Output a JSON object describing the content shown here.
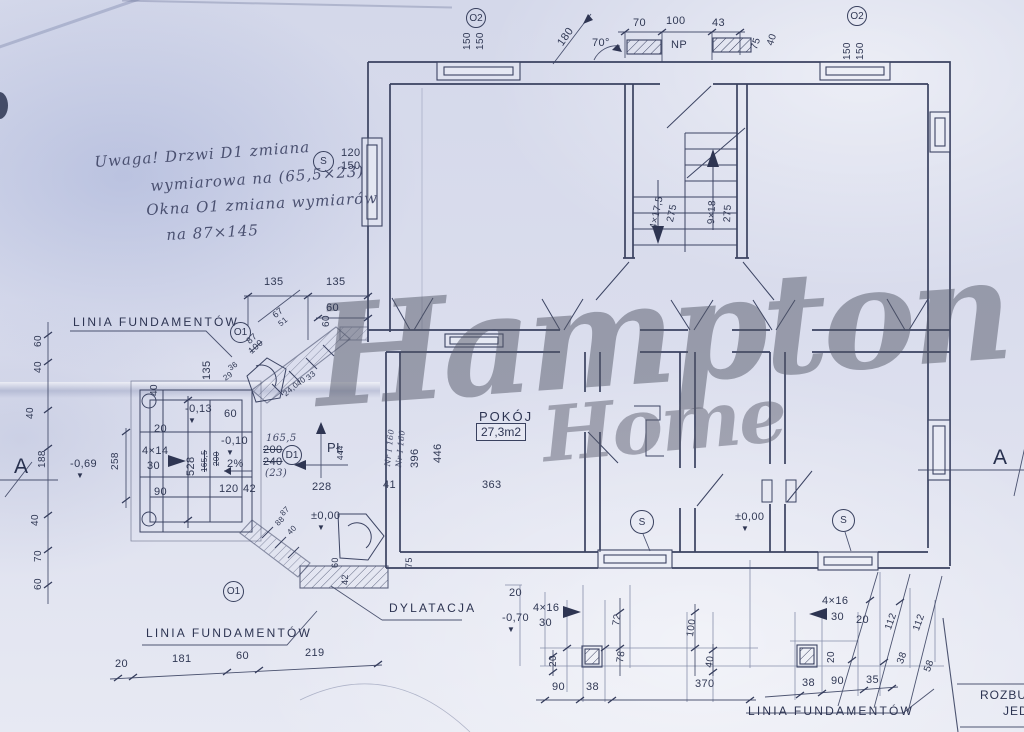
{
  "watermark": {
    "line1": "Hampton",
    "line2": "Home"
  },
  "title_block": {
    "line1": "ROZBU",
    "line2": "JED"
  },
  "rooms": {
    "pokoj": {
      "name": "POKÓJ",
      "area": "27,3m2"
    }
  },
  "callouts": [
    {
      "t": "O2",
      "x": 466,
      "y": 8,
      "d": 20
    },
    {
      "t": "O2",
      "x": 847,
      "y": 6,
      "d": 20
    },
    {
      "t": "S",
      "x": 313,
      "y": 151,
      "d": 21
    },
    {
      "t": "O1",
      "x": 230,
      "y": 322,
      "d": 21
    },
    {
      "t": "D1",
      "x": 282,
      "y": 445,
      "d": 20
    },
    {
      "t": "S",
      "x": 630,
      "y": 510,
      "d": 24
    },
    {
      "t": "S",
      "x": 832,
      "y": 509,
      "d": 23
    },
    {
      "t": "O1",
      "x": 223,
      "y": 581,
      "d": 21
    }
  ],
  "labels": [
    {
      "t": "150",
      "x": 463,
      "y": 50,
      "r": -90,
      "s": 10
    },
    {
      "t": "150",
      "x": 476,
      "y": 50,
      "r": -90,
      "s": 10
    },
    {
      "t": "180",
      "x": 556,
      "y": 42,
      "r": -55
    },
    {
      "t": "70°",
      "x": 592,
      "y": 38
    },
    {
      "t": "70",
      "x": 633,
      "y": 18
    },
    {
      "t": "100",
      "x": 666,
      "y": 16
    },
    {
      "t": "43",
      "x": 712,
      "y": 18
    },
    {
      "t": "NP",
      "x": 671,
      "y": 40,
      "n": "np-label"
    },
    {
      "t": "75",
      "x": 750,
      "y": 48,
      "r": -72,
      "s": 10
    },
    {
      "t": "40",
      "x": 766,
      "y": 44,
      "r": -72,
      "s": 10
    },
    {
      "t": "150",
      "x": 843,
      "y": 60,
      "r": -90,
      "s": 10
    },
    {
      "t": "150",
      "x": 856,
      "y": 60,
      "r": -90,
      "s": 10
    },
    {
      "t": "120",
      "x": 341,
      "y": 148
    },
    {
      "t": "150",
      "x": 341,
      "y": 161
    },
    {
      "t": "Uwaga! Drzwi D1 zmiana",
      "x": 94,
      "y": 155,
      "r": -4,
      "c": "hand",
      "n": "note-line-1"
    },
    {
      "t": "wymiarowa na (65,5×23)",
      "x": 150,
      "y": 179,
      "r": -4,
      "c": "hand",
      "n": "note-line-2"
    },
    {
      "t": "Okna O1 zmiana wymiarów",
      "x": 146,
      "y": 203,
      "r": -3,
      "c": "hand",
      "n": "note-line-3"
    },
    {
      "t": "na 87×145",
      "x": 166,
      "y": 228,
      "r": -3,
      "c": "hand",
      "n": "note-line-4"
    },
    {
      "t": "4×17,5",
      "x": 649,
      "y": 228,
      "r": -78,
      "s": 10
    },
    {
      "t": "275",
      "x": 666,
      "y": 221,
      "r": -78,
      "s": 10
    },
    {
      "t": "9×18",
      "x": 707,
      "y": 224,
      "r": -87,
      "s": 10
    },
    {
      "t": "275",
      "x": 723,
      "y": 222,
      "r": -87,
      "s": 10
    },
    {
      "t": "135",
      "x": 264,
      "y": 277
    },
    {
      "t": "135",
      "x": 326,
      "y": 277
    },
    {
      "t": "67",
      "x": 271,
      "y": 313,
      "r": -40,
      "s": 9
    },
    {
      "t": "51",
      "x": 277,
      "y": 322,
      "r": -40,
      "s": 8
    },
    {
      "t": "60",
      "x": 326,
      "y": 303
    },
    {
      "t": "LINIA FUNDAMENTÓW",
      "x": 73,
      "y": 316,
      "c": "fund",
      "n": "linia-fundamentow-left"
    },
    {
      "t": "87",
      "x": 245,
      "y": 339,
      "r": -42,
      "s": 9
    },
    {
      "t": "100",
      "x": 247,
      "y": 349,
      "r": -42,
      "s": 9,
      "c": "strike"
    },
    {
      "t": "135",
      "x": 202,
      "y": 380,
      "r": -90
    },
    {
      "t": "36",
      "x": 227,
      "y": 366,
      "r": -35,
      "s": 8
    },
    {
      "t": "29",
      "x": 222,
      "y": 376,
      "r": -35,
      "s": 8
    },
    {
      "t": "60",
      "x": 322,
      "y": 327,
      "r": -90,
      "s": 10
    },
    {
      "t": "40",
      "x": 150,
      "y": 396,
      "r": -90,
      "s": 10
    },
    {
      "t": "24,0",
      "x": 282,
      "y": 392,
      "r": -40,
      "s": 8
    },
    {
      "t": "40",
      "x": 295,
      "y": 382,
      "r": -40,
      "s": 8
    },
    {
      "t": "33",
      "x": 305,
      "y": 376,
      "r": -40,
      "s": 8
    },
    {
      "t": "60",
      "x": 34,
      "y": 347,
      "r": -90,
      "s": 10
    },
    {
      "t": "40",
      "x": 34,
      "y": 373,
      "r": -90,
      "s": 10
    },
    {
      "t": "40",
      "x": 26,
      "y": 419,
      "r": -90,
      "s": 10
    },
    {
      "t": "188",
      "x": 38,
      "y": 468,
      "r": -90,
      "s": 10
    },
    {
      "t": "-0,69",
      "x": 70,
      "y": 459,
      "n": "level-marker"
    },
    {
      "t": "▼",
      "x": 76,
      "y": 472,
      "c": "tri",
      "n": "level-triangle-icon"
    },
    {
      "t": "258",
      "x": 111,
      "y": 470,
      "r": -90,
      "s": 10
    },
    {
      "t": "A",
      "x": 14,
      "y": 456,
      "c": "marker",
      "n": "section-marker-a-left"
    },
    {
      "t": "40",
      "x": 31,
      "y": 526,
      "r": -90,
      "s": 10
    },
    {
      "t": "70",
      "x": 34,
      "y": 562,
      "r": -90,
      "s": 10
    },
    {
      "t": "60",
      "x": 34,
      "y": 590,
      "r": -90,
      "s": 10
    },
    {
      "t": "-0,13",
      "x": 185,
      "y": 404,
      "n": "level-marker"
    },
    {
      "t": "▼",
      "x": 188,
      "y": 417,
      "c": "tri",
      "n": "level-triangle-icon"
    },
    {
      "t": "60",
      "x": 224,
      "y": 409
    },
    {
      "t": "20",
      "x": 154,
      "y": 424
    },
    {
      "t": "4×14",
      "x": 142,
      "y": 446
    },
    {
      "t": "30",
      "x": 147,
      "y": 461
    },
    {
      "t": "528",
      "x": 186,
      "y": 476,
      "r": -90
    },
    {
      "t": "165,5",
      "x": 201,
      "y": 472,
      "r": -90,
      "s": 8,
      "c": "strike"
    },
    {
      "t": "200",
      "x": 213,
      "y": 466,
      "r": -90,
      "s": 8,
      "c": "strike"
    },
    {
      "t": "-0,10",
      "x": 221,
      "y": 436,
      "n": "level-marker"
    },
    {
      "t": "▼",
      "x": 226,
      "y": 449,
      "c": "tri",
      "n": "level-triangle-icon"
    },
    {
      "t": "2%",
      "x": 227,
      "y": 459
    },
    {
      "t": "90",
      "x": 154,
      "y": 487
    },
    {
      "t": "120",
      "x": 219,
      "y": 484
    },
    {
      "t": "42",
      "x": 243,
      "y": 484
    },
    {
      "t": "165,5",
      "x": 266,
      "y": 434,
      "c": "hand2",
      "n": "door-dim-new"
    },
    {
      "t": "200",
      "x": 263,
      "y": 445,
      "c": "strike"
    },
    {
      "t": "240",
      "x": 263,
      "y": 457,
      "c": "strike"
    },
    {
      "t": "(23)",
      "x": 265,
      "y": 469,
      "c": "hand2"
    },
    {
      "t": "PŁ",
      "x": 327,
      "y": 441,
      "s": 13,
      "n": "north-label"
    },
    {
      "t": "444",
      "x": 337,
      "y": 460,
      "r": -90,
      "s": 8
    },
    {
      "t": "228",
      "x": 312,
      "y": 482
    },
    {
      "t": "±0,00",
      "x": 311,
      "y": 511,
      "n": "level-marker"
    },
    {
      "t": "▼",
      "x": 317,
      "y": 524,
      "c": "tri",
      "n": "level-triangle-icon"
    },
    {
      "t": "87",
      "x": 279,
      "y": 512,
      "r": -45,
      "s": 8
    },
    {
      "t": "88",
      "x": 274,
      "y": 522,
      "r": -45,
      "s": 8
    },
    {
      "t": "40",
      "x": 286,
      "y": 531,
      "r": -45,
      "s": 8
    },
    {
      "t": "42",
      "x": 341,
      "y": 585,
      "r": -90,
      "s": 9
    },
    {
      "t": "60",
      "x": 331,
      "y": 568,
      "r": -90,
      "s": 9
    },
    {
      "t": "75",
      "x": 405,
      "y": 568,
      "r": -90,
      "s": 9
    },
    {
      "t": "363",
      "x": 482,
      "y": 480
    },
    {
      "t": "41",
      "x": 383,
      "y": 480
    },
    {
      "t": "396",
      "x": 410,
      "y": 468,
      "r": -90
    },
    {
      "t": "446",
      "x": 433,
      "y": 463,
      "r": -90
    },
    {
      "t": "Nr I 160",
      "x": 384,
      "y": 466,
      "r": -84,
      "s": 8,
      "c": "hand2"
    },
    {
      "t": "Nr I 160",
      "x": 395,
      "y": 467,
      "r": -84,
      "s": 8,
      "c": "hand2"
    },
    {
      "t": "±0,00",
      "x": 735,
      "y": 512,
      "n": "level-marker"
    },
    {
      "t": "▼",
      "x": 741,
      "y": 525,
      "c": "tri",
      "n": "level-triangle-icon"
    },
    {
      "t": "20",
      "x": 509,
      "y": 588
    },
    {
      "t": "-0,70",
      "x": 502,
      "y": 613,
      "n": "level-marker"
    },
    {
      "t": "▼",
      "x": 507,
      "y": 626,
      "c": "tri",
      "n": "level-triangle-icon"
    },
    {
      "t": "4×16",
      "x": 533,
      "y": 603
    },
    {
      "t": "30",
      "x": 539,
      "y": 618
    },
    {
      "t": "72",
      "x": 612,
      "y": 625,
      "r": -82,
      "s": 10
    },
    {
      "t": "78",
      "x": 616,
      "y": 662,
      "r": -82,
      "s": 10
    },
    {
      "t": "20",
      "x": 549,
      "y": 667,
      "r": -90,
      "s": 10
    },
    {
      "t": "100",
      "x": 686,
      "y": 636,
      "r": -82,
      "s": 10
    },
    {
      "t": "40",
      "x": 705,
      "y": 667,
      "r": -82,
      "s": 10
    },
    {
      "t": "90",
      "x": 552,
      "y": 682
    },
    {
      "t": "38",
      "x": 586,
      "y": 682
    },
    {
      "t": "370",
      "x": 695,
      "y": 679
    },
    {
      "t": "DYLATACJA",
      "x": 389,
      "y": 602,
      "c": "fund",
      "n": "dylatacja-label"
    },
    {
      "t": "4×16",
      "x": 822,
      "y": 596
    },
    {
      "t": "30",
      "x": 831,
      "y": 612
    },
    {
      "t": "20",
      "x": 856,
      "y": 615
    },
    {
      "t": "20",
      "x": 827,
      "y": 663,
      "r": -90,
      "s": 10
    },
    {
      "t": "112",
      "x": 884,
      "y": 628,
      "r": -70,
      "s": 10
    },
    {
      "t": "112",
      "x": 912,
      "y": 629,
      "r": -70,
      "s": 10
    },
    {
      "t": "38",
      "x": 896,
      "y": 662,
      "r": -70,
      "s": 10
    },
    {
      "t": "58",
      "x": 923,
      "y": 670,
      "r": -70,
      "s": 10
    },
    {
      "t": "38",
      "x": 802,
      "y": 678
    },
    {
      "t": "90",
      "x": 831,
      "y": 676
    },
    {
      "t": "35",
      "x": 866,
      "y": 675
    },
    {
      "t": "LINIA FUNDAMENTÓW",
      "x": 748,
      "y": 705,
      "c": "fund",
      "n": "linia-fundamentow-bottom-right"
    },
    {
      "t": "LINIA FUNDAMENTÓW",
      "x": 146,
      "y": 627,
      "c": "fund",
      "n": "linia-fundamentow-bottom-left"
    },
    {
      "t": "20",
      "x": 115,
      "y": 659
    },
    {
      "t": "181",
      "x": 172,
      "y": 654
    },
    {
      "t": "60",
      "x": 236,
      "y": 651
    },
    {
      "t": "219",
      "x": 305,
      "y": 648
    },
    {
      "t": "A",
      "x": 993,
      "y": 447,
      "c": "marker",
      "n": "section-marker-a-right"
    }
  ]
}
